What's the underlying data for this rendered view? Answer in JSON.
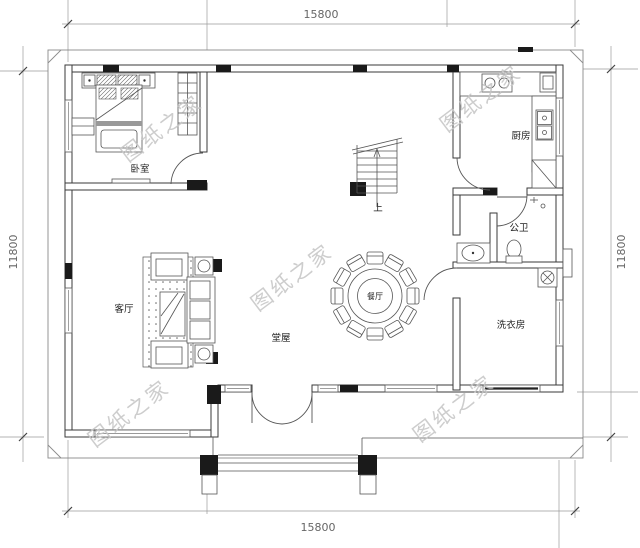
{
  "meta": {
    "type": "architectural-floor-plan"
  },
  "dims": {
    "top": "15800",
    "bottom": "15800",
    "left": "11800",
    "right": "11800"
  },
  "rooms": {
    "bedroom": "卧室",
    "living": "客厅",
    "hall": "堂屋",
    "dining": "餐厅",
    "kitchen": "厨房",
    "bath": "公卫",
    "laundry": "洗衣房",
    "stair": "上"
  },
  "watermark": {
    "text": "图纸之家",
    "color": "#c5c5c5"
  },
  "colors": {
    "wall": "#3a3a3a",
    "furniture": "#555555",
    "dimension": "#9a9a9a",
    "text": "#222222",
    "background": "#ffffff"
  }
}
